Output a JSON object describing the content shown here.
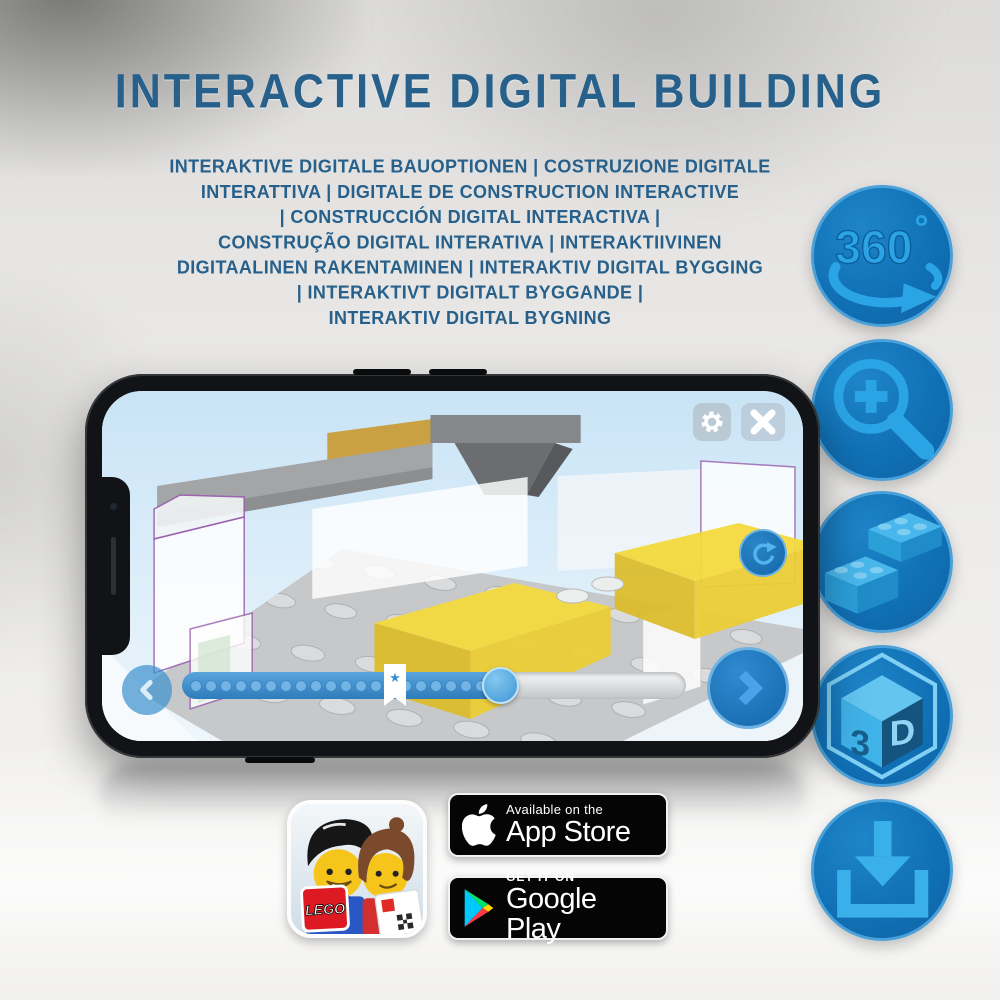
{
  "header": {
    "title": "INTERACTIVE DIGITAL BUILDING",
    "subtitle_lines": [
      "INTERAKTIVE DIGITALE BAUOPTIONEN | COSTRUZIONE DIGITALE",
      "INTERATTIVA | DIGITALE DE CONSTRUCTION INTERACTIVE",
      "| CONSTRUCCIÓN DIGITAL INTERACTIVA |",
      "CONSTRUÇÃO DIGITAL INTERATIVA | INTERAKTIIVINEN",
      "DIGITAALINEN RAKENTAMINEN | INTERAKTIV DIGITAL BYGGING",
      "| INTERAKTIVT DIGITALT BYGGANDE |",
      "INTERAKTIV DIGITAL BYGNING"
    ]
  },
  "features": [
    {
      "id": "rotate-360",
      "label": "360",
      "degree": "°"
    },
    {
      "id": "zoom-in"
    },
    {
      "id": "brick-builder"
    },
    {
      "id": "3d-view",
      "left": "3",
      "right": "D"
    },
    {
      "id": "download"
    }
  ],
  "phone_ui": {
    "bookmark_star": "★"
  },
  "badges": {
    "lego_app": {
      "logo_text": "LEGO"
    },
    "app_store": {
      "tagline": "Available on the",
      "store": "App Store"
    },
    "google_play": {
      "tagline": "GET IT ON",
      "store": "Google Play"
    }
  },
  "colors": {
    "title_blue": "#27608a",
    "circle_blue": "#1171b6",
    "glyph_blue": "#2ba4e6",
    "brick_yellow": "#f4da3e"
  }
}
